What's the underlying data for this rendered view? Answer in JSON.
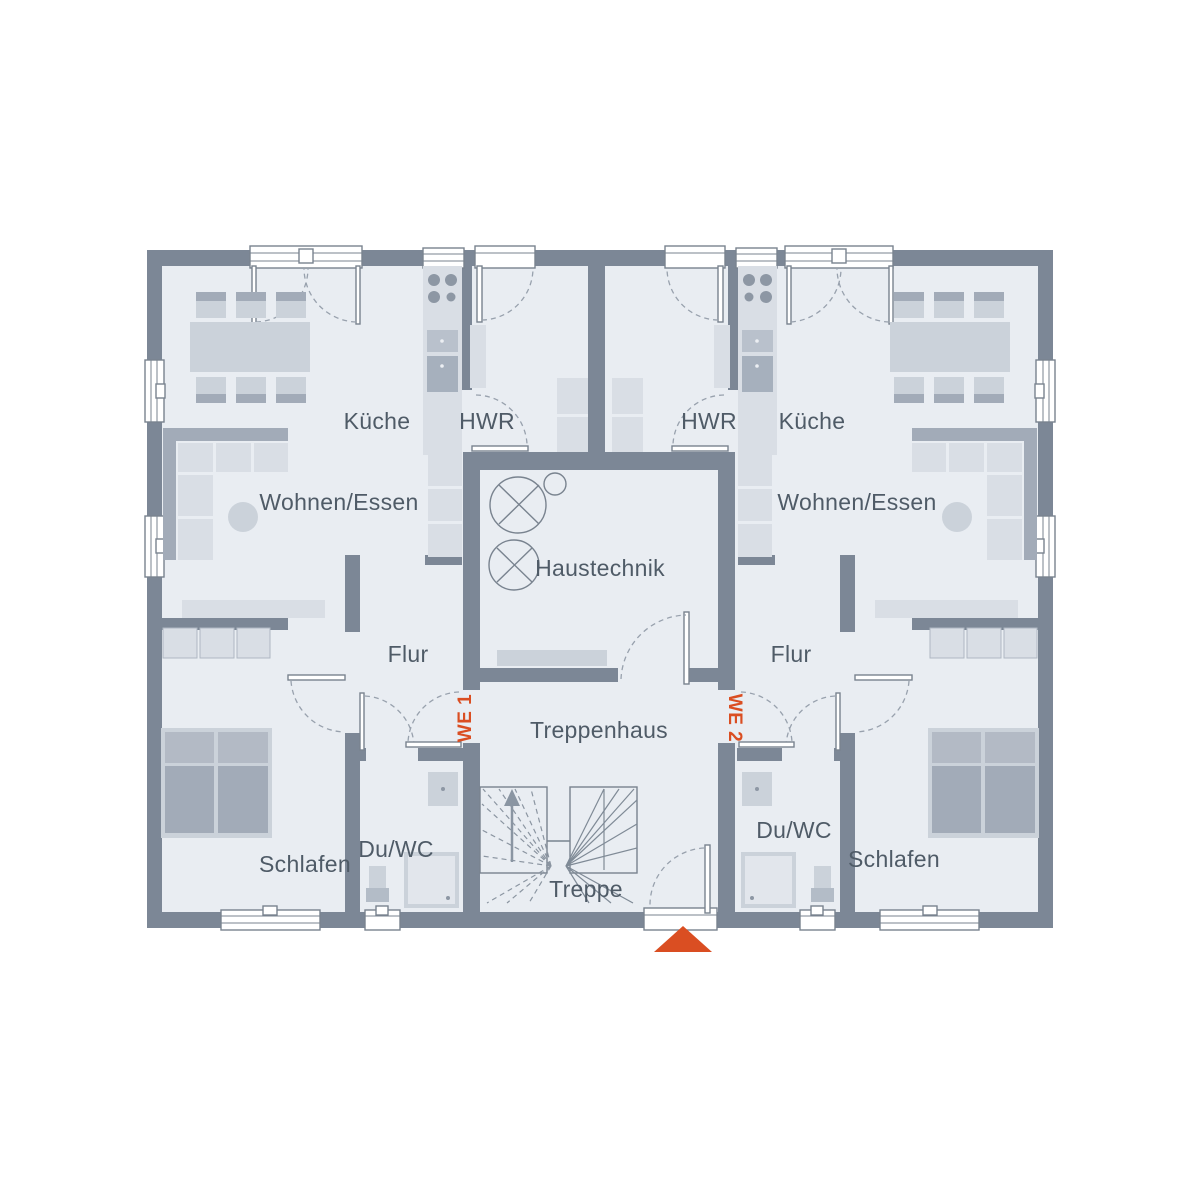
{
  "floor_plan": {
    "units": [
      {
        "id": "WE 1",
        "rooms": {
          "kueche": "Küche",
          "hwr": "HWR",
          "wohnen_essen": "Wohnen/Essen",
          "flur": "Flur",
          "schlafen": "Schlafen",
          "du_wc": "Du/WC"
        }
      },
      {
        "id": "WE 2",
        "rooms": {
          "kueche": "Küche",
          "hwr": "HWR",
          "wohnen_essen": "Wohnen/Essen",
          "flur": "Flur",
          "schlafen": "Schlafen",
          "du_wc": "Du/WC"
        }
      }
    ],
    "shared_rooms": {
      "haustechnik": "Haustechnik",
      "treppenhaus": "Treppenhaus",
      "treppe": "Treppe"
    }
  },
  "theme": {
    "wall": "#7c8796",
    "floor": "#e9edf2",
    "accent": "#da4e22",
    "label": "#4f5b67",
    "background": "#ffffff"
  }
}
